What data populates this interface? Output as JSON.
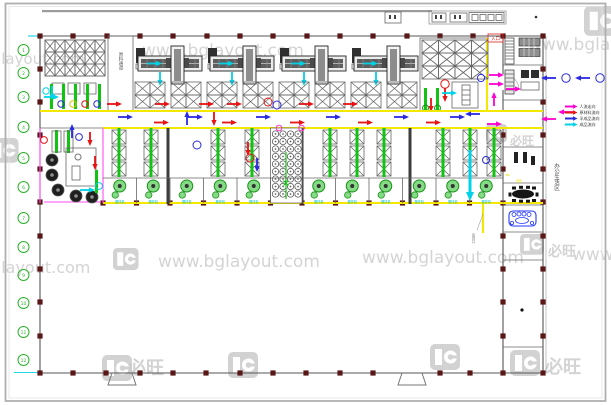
{
  "document": {
    "kind": "factory-equipment-layout-cad-plan",
    "background": "#ffffff"
  },
  "watermarks": {
    "url": "www.bglayout.com",
    "brand_name": "必旺",
    "logo_icon": "bg-logo"
  },
  "legend": {
    "items": [
      {
        "label": "人流走向",
        "color": "#ff00d0"
      },
      {
        "label": "原材料流向",
        "color": "#e81313"
      },
      {
        "label": "半成品流向",
        "color": "#2a2ae0"
      },
      {
        "label": "成品流向",
        "color": "#00d2e8"
      }
    ]
  },
  "labels": {
    "corridor_room": "原料通道",
    "entry_badge": "入口",
    "exit_note": "出货口",
    "right_wing_vertical": "办公生活区",
    "mixer_tag": "搅拌机"
  },
  "grid_bubbles": {
    "left": [
      "1",
      "2",
      "3",
      "4",
      "5",
      "6",
      "7",
      "8",
      "9",
      "10",
      "11",
      "12"
    ]
  },
  "colors": {
    "walkway_line": "#f5e800",
    "machine_green": "#17a317",
    "personnel_flow": "#ff00d0",
    "raw_material_flow": "#e81313",
    "semi_product_flow": "#2a2ae0",
    "finished_product_flow": "#00d2e8",
    "structural_column": "#5a1717",
    "watermark_gray": "#c9c9c9"
  }
}
